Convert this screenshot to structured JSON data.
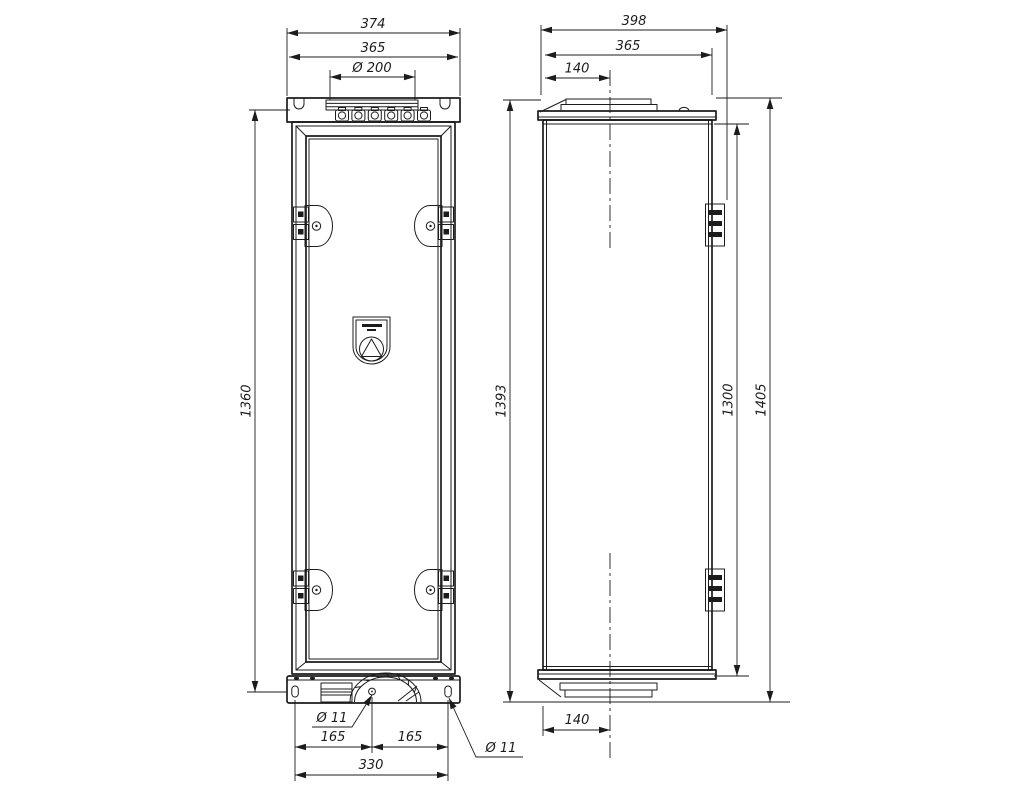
{
  "colors": {
    "background": "#ffffff",
    "line": "#1c1c1c"
  },
  "dims": {
    "front": {
      "overall_width": "374",
      "inner_width": "365",
      "gland_plate_dia": "Ø 200",
      "frame_height": "1360",
      "center_hole_dia": "Ø 11",
      "corner_hole_dia": "Ø 11",
      "hole_pitch_left": "165",
      "hole_pitch_right": "165",
      "hole_span": "330"
    },
    "side": {
      "overall_depth": "398",
      "body_depth": "365",
      "plate_offset_top": "140",
      "left_height": "1393",
      "body_height": "1300",
      "overall_height": "1405",
      "plate_offset_bottom": "140"
    }
  },
  "logo": {
    "icon": "triangle-in-circle-badge"
  }
}
